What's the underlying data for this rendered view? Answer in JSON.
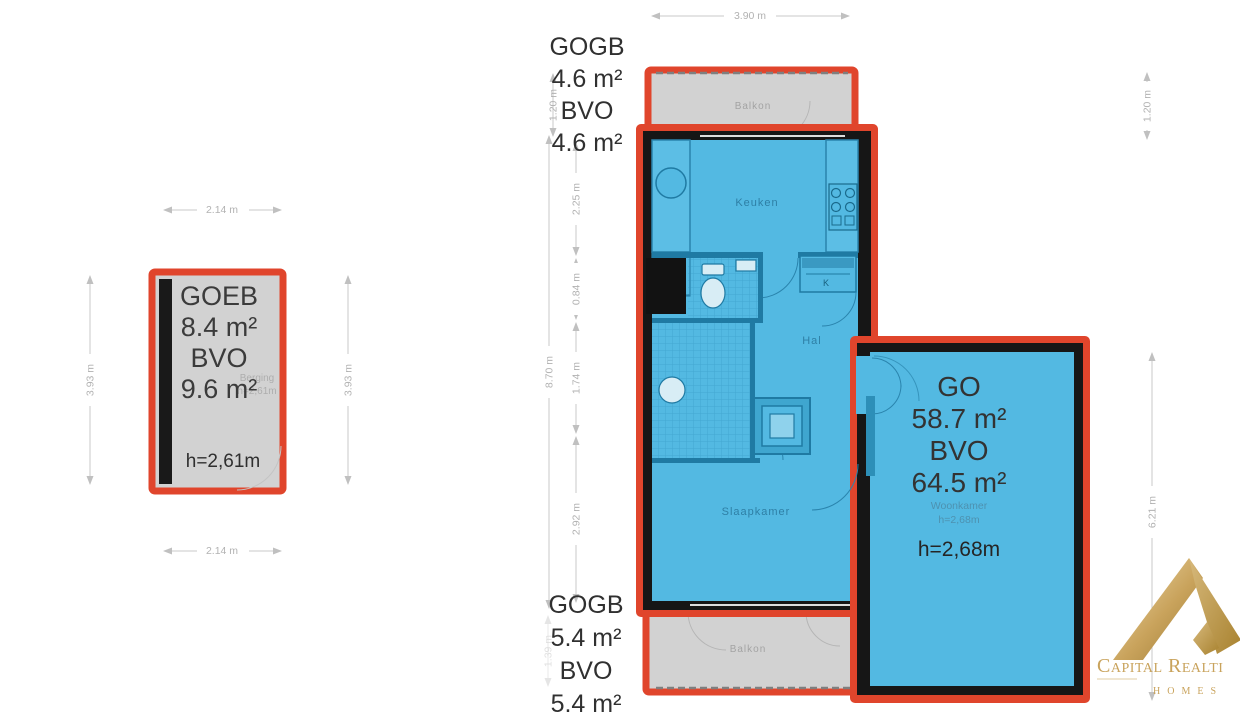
{
  "colors": {
    "accent_red": "#e0452c",
    "floor_blue": "#53b9e2",
    "wall_black": "#161616",
    "balcony_gray": "#d2d2d2",
    "dim_gray": "#c6c6c6",
    "text_dark": "#333333",
    "room_label_blue": "#2e7fa5",
    "logo_gold": "#c9a35c"
  },
  "storage": {
    "annotation": [
      "GOEB",
      "8.4 m²",
      "BVO",
      "9.6 m²"
    ],
    "faint_room": "Berging",
    "faint_height": "h=2,61m",
    "height_label": "h=2,61m"
  },
  "apartment": {
    "annotation_top": [
      "GOGB",
      "4.6 m²",
      "BVO",
      "4.6 m²"
    ],
    "annotation_bottom": [
      "GOGB",
      "5.4 m²",
      "BVO",
      "5.4 m²"
    ],
    "annotation_living": [
      "GO",
      "58.7 m²",
      "BVO",
      "64.5 m²"
    ],
    "living_faint_room": "Woonkamer",
    "living_faint_height": "h=2,68m",
    "living_height_label": "h=2,68m",
    "rooms": {
      "kitchen": "Keuken",
      "hall": "Hal",
      "bedroom": "Slaapkamer",
      "closet": "K",
      "balcony_top": "Balkon",
      "balcony_bottom": "Balkon"
    }
  },
  "dims": {
    "storage_top": "2.14 m",
    "storage_bottom": "2.14 m",
    "storage_left": "3.93 m",
    "storage_right": "3.93 m",
    "balcony_width": "3.90 m",
    "balcony_left": "1.20 m",
    "balcony_right": "1.20 m",
    "plan_height": "8.70 m",
    "seg_kitchen": "2.25 m",
    "seg_toilet": "0.84 m",
    "seg_hall": "1.74 m",
    "seg_bedroom": "2.92 m",
    "living_right": "6.21 m",
    "balcony_bottom_left": "1.39 m"
  },
  "logo": {
    "brand": "Capital Realti",
    "sub": "HOMES"
  }
}
